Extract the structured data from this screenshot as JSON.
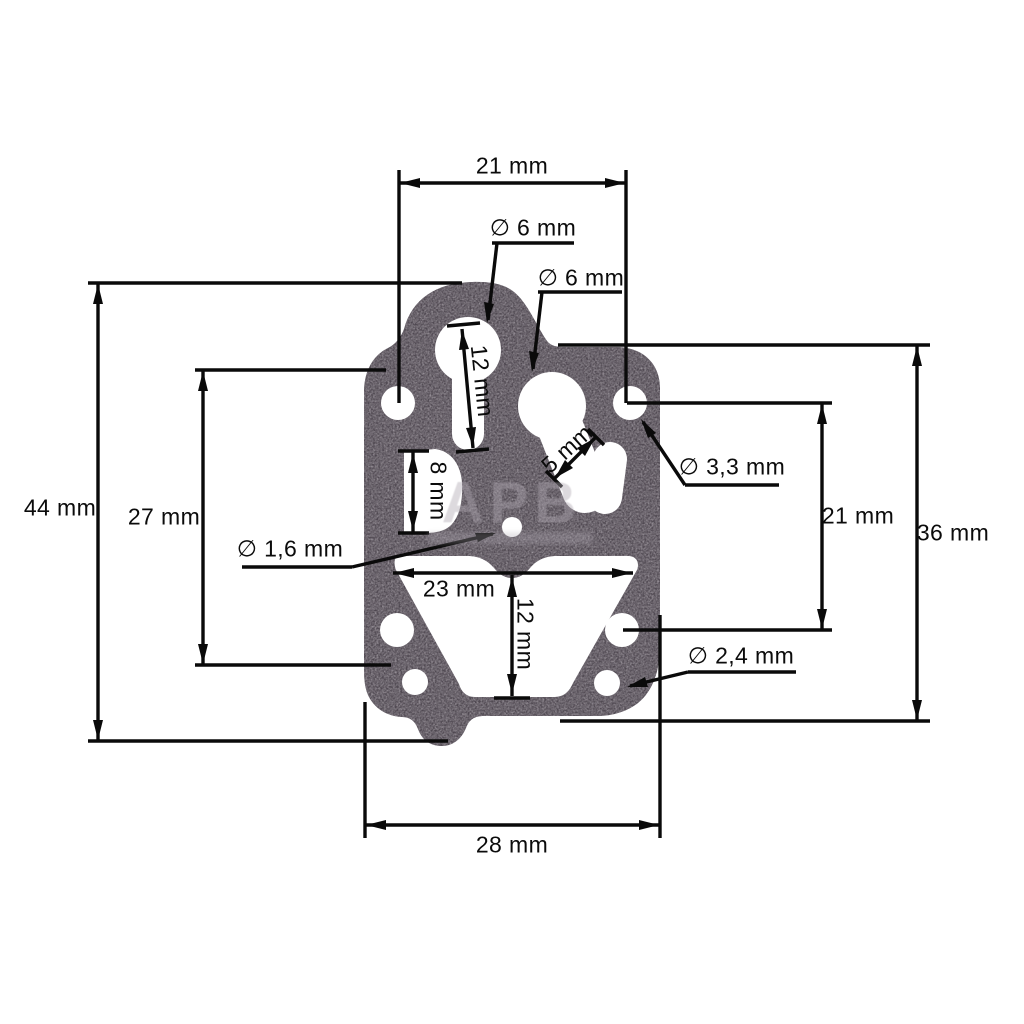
{
  "watermark": {
    "text": "APB"
  },
  "labels": {
    "top_width": "21 mm",
    "dia_top_hole": "∅ 6 mm",
    "dia_mid_hole": "∅ 6 mm",
    "overall_height": "44 mm",
    "left_span": "27 mm",
    "keyhole_slot": "12 mm",
    "d_hole_height": "8 mm",
    "neck_width": "5 mm",
    "dia_pin_hole": "∅ 1,6 mm",
    "dia_screw_hole": "∅ 3,3 mm",
    "right_hole_span": "21 mm",
    "right_height": "36 mm",
    "dia_bottom_hole": "∅ 2,4 mm",
    "cutout_width": "23 mm",
    "cutout_height": "12 mm",
    "bottom_width": "28 mm"
  }
}
